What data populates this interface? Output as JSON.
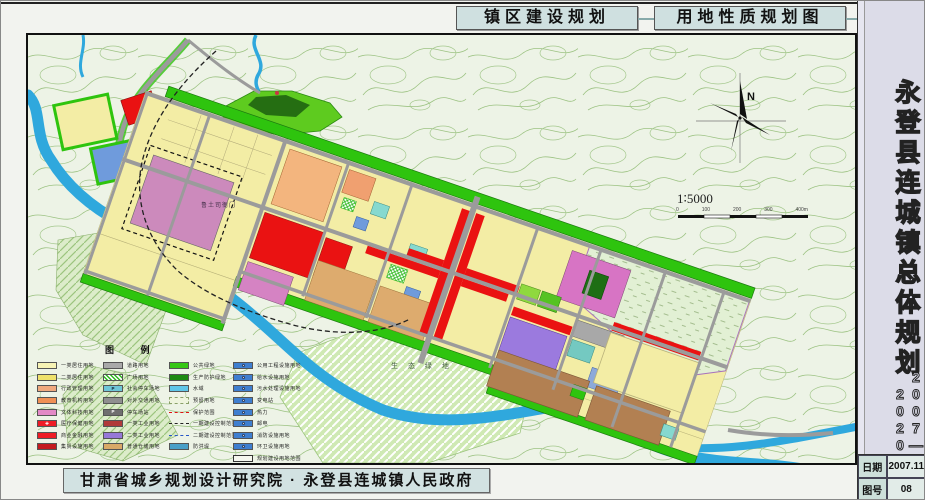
{
  "page": {
    "tabs": [
      {
        "label": "镇区建设规划"
      },
      {
        "label": "用地性质规划图"
      }
    ]
  },
  "sidebar": {
    "title_vertical": "永登县连城镇总体规划",
    "years": "2007——2020",
    "info": [
      {
        "label": "日期",
        "value": "2007.11"
      },
      {
        "label": "图号",
        "value": "08"
      }
    ]
  },
  "footer": {
    "credit": "甘肃省城乡规划设计研究院 · 永登县连城镇人民政府"
  },
  "map": {
    "labels": {
      "landmark": "鲁土司衙门",
      "eco_green": "生 态 绿 地",
      "north": "N",
      "scale": "1∶5000",
      "scale_ticks": [
        "0",
        "100",
        "200",
        "300",
        "400m"
      ]
    }
  },
  "legend": {
    "title": "图 例",
    "columns": [
      [
        {
          "label": "一类居住用地",
          "type": "solid",
          "color": "#f7f3b5"
        },
        {
          "label": "二类居住用地",
          "type": "solid",
          "color": "#efe26b"
        },
        {
          "label": "行政管理用地",
          "type": "solid",
          "color": "#f0a97e"
        },
        {
          "label": "教育机构用地",
          "type": "solid",
          "color": "#ef9055"
        },
        {
          "label": "文体科技用地",
          "type": "solid",
          "color": "#e389c6"
        },
        {
          "label": "医疗保健用地",
          "type": "solid",
          "color": "#ee1c25",
          "glyph": "cross"
        },
        {
          "label": "商业金融用地",
          "type": "solid",
          "color": "#ee1c25"
        },
        {
          "label": "集贸设施用地",
          "type": "solid",
          "color": "#c41a1f"
        }
      ],
      [
        {
          "label": "道路用地",
          "type": "solid",
          "color": "#a9a9a9"
        },
        {
          "label": "广场用地",
          "type": "hatch"
        },
        {
          "label": "社会停车场地",
          "type": "solid",
          "color": "#6ec6d8",
          "glyph": "P-dark"
        },
        {
          "label": "对外交通用地",
          "type": "solid",
          "color": "#8f8f8f"
        },
        {
          "label": "停车场站",
          "type": "solid",
          "color": "#6f6f6f",
          "glyph": "P"
        },
        {
          "label": "一类工业用地",
          "type": "solid",
          "color": "#b03a3a"
        },
        {
          "label": "二类工业用地",
          "type": "solid",
          "color": "#9678d8"
        },
        {
          "label": "普通仓储用地",
          "type": "solid",
          "color": "#d9a967"
        }
      ],
      [
        {
          "label": "公共绿地",
          "type": "solid",
          "color": "#35c715"
        },
        {
          "label": "生产防护绿地",
          "type": "solid",
          "color": "#1d8a12"
        },
        {
          "label": "水域",
          "type": "solid",
          "color": "#5fc6e8"
        },
        {
          "label": "预留用地",
          "type": "reserved"
        },
        {
          "label": "保护范围",
          "type": "line-red"
        },
        {
          "label": "一期建设控制范围",
          "type": "line-dashdot"
        },
        {
          "label": "二期建设控制范围",
          "type": "line-blue"
        },
        {
          "label": "防洪堤",
          "type": "solid",
          "color": "#4a9fc8"
        }
      ],
      [
        {
          "label": "公用工程设施用地",
          "type": "solid",
          "color": "#3f7fd0",
          "glyph": "dot"
        },
        {
          "label": "给水设施用地",
          "type": "solid",
          "color": "#3f7fd0",
          "glyph": "dot"
        },
        {
          "label": "污水处理设施用地",
          "type": "solid",
          "color": "#3f7fd0",
          "glyph": "dot"
        },
        {
          "label": "变电站",
          "type": "solid",
          "color": "#3f7fd0",
          "glyph": "dot"
        },
        {
          "label": "热力",
          "type": "solid",
          "color": "#3f7fd0",
          "glyph": "dot"
        },
        {
          "label": "邮电",
          "type": "solid",
          "color": "#3f7fd0",
          "glyph": "dot"
        },
        {
          "label": "消防设施用地",
          "type": "solid",
          "color": "#3f7fd0",
          "glyph": "dot"
        },
        {
          "label": "环卫设施用地",
          "type": "solid",
          "color": "#3f7fd0",
          "glyph": "dot"
        },
        {
          "label": "规划建设用地范围",
          "type": "outline"
        }
      ]
    ]
  },
  "colors": {
    "residential_yellow": "#f3eda5",
    "commercial_red": "#ea1212",
    "landmark_pink": "#cc8abc",
    "green_belt": "#2ec40e",
    "river_blue": "#2fa8dd",
    "road_gray": "#9b9b9b",
    "tab_bg": "#cfe0e0",
    "sidebar_bg": "#dcdce8"
  }
}
